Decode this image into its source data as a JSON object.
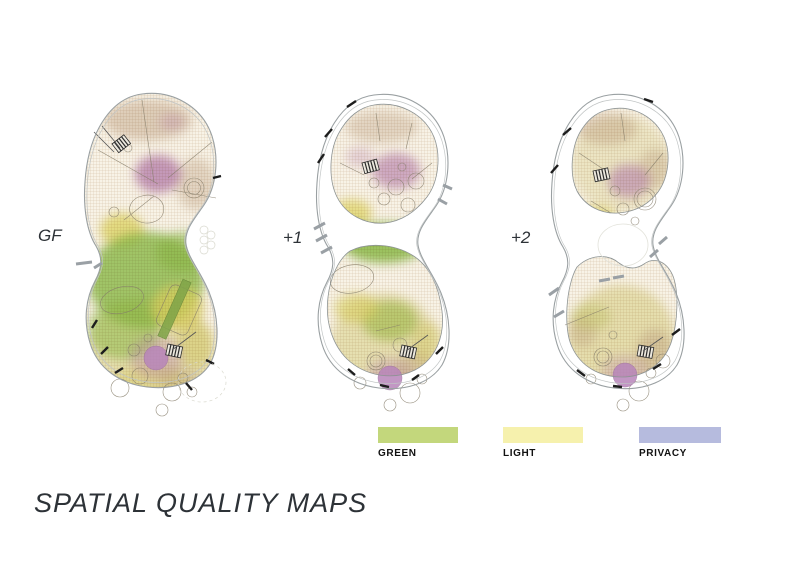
{
  "title": "SPATIAL QUALITY MAPS",
  "floors": [
    {
      "id": "gf",
      "label": "GF"
    },
    {
      "id": "plus1",
      "label": "+1"
    },
    {
      "id": "plus2",
      "label": "+2"
    }
  ],
  "legend": {
    "items": [
      {
        "label": "GREEN",
        "color": "#c3d77c"
      },
      {
        "label": "LIGHT",
        "color": "#f6f1ad"
      },
      {
        "label": "PRIVACY",
        "color": "#b6bbde"
      }
    ]
  },
  "map_colors": {
    "green": "#8fc24f",
    "light": "#e5df72",
    "privacy": "#bd89bf",
    "plan_base": "#f8f3e7"
  }
}
